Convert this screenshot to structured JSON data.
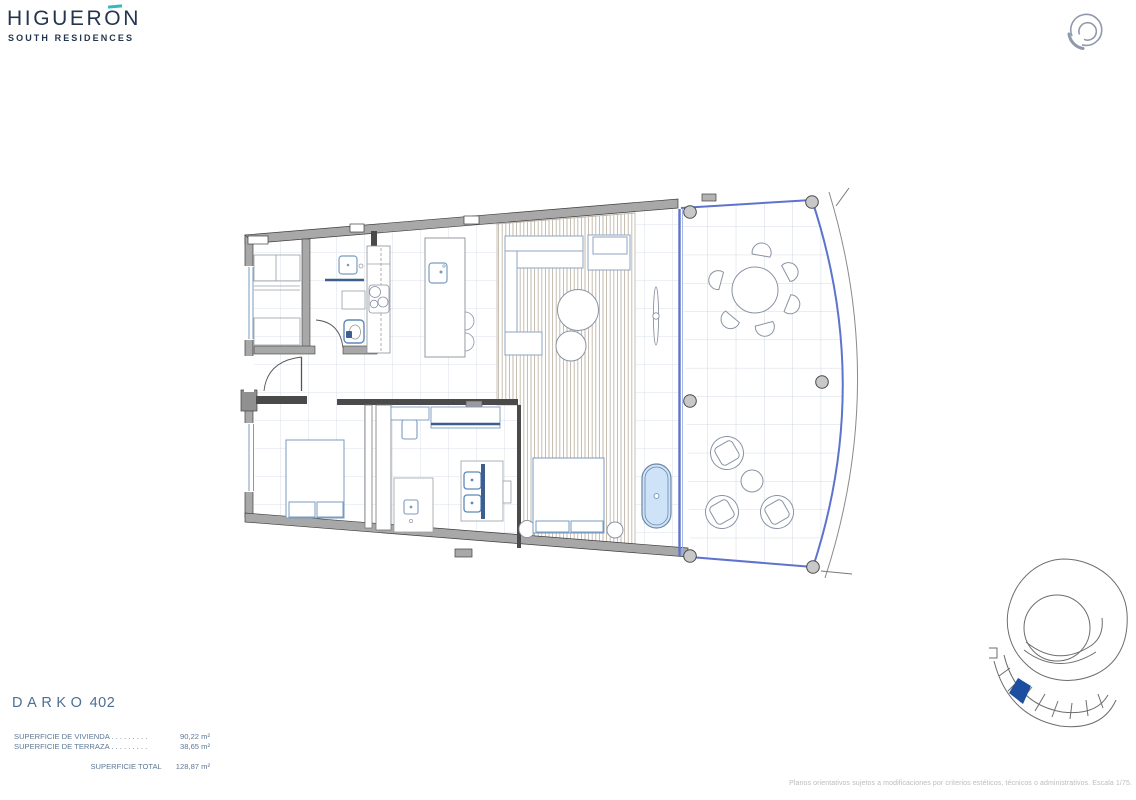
{
  "brand": {
    "name": "HIGUERON",
    "tagline": "SOUTH RESIDENCES",
    "navy": "#24364e",
    "teal": "#35b9c0"
  },
  "header": {
    "icon": "spiral-logo-icon",
    "icon_color": "#8e9aab"
  },
  "unit": {
    "name": "DARKO",
    "number": "402"
  },
  "areas": {
    "rows": [
      {
        "label": "SUPERFICIE DE VIVIENDA",
        "leader": " . . . . . . . . .",
        "value": "90,22 m²"
      },
      {
        "label": "SUPERFICIE DE TERRAZA",
        "leader": " . . . . . . . . .",
        "value": "38,65 m²"
      }
    ],
    "total": {
      "label": "SUPERFICIE TOTAL",
      "value": "128,87 m²"
    }
  },
  "disclaimer": "Planos orientativos sujetos a modificaciones por criterios estéticos, técnicos o administrativos. Escala 1/75.",
  "floorplan": {
    "wall_color": "#a8a8a8",
    "grid_color": "#cfd8e4",
    "wood_deck_color": "#b6ad9b",
    "glass_wall_color": "#5d74cc",
    "fixture_color": "#7a9bc0",
    "bathtub_fill": "#cfe3f8",
    "highlighted_unit_color": "#1d4fa1"
  }
}
